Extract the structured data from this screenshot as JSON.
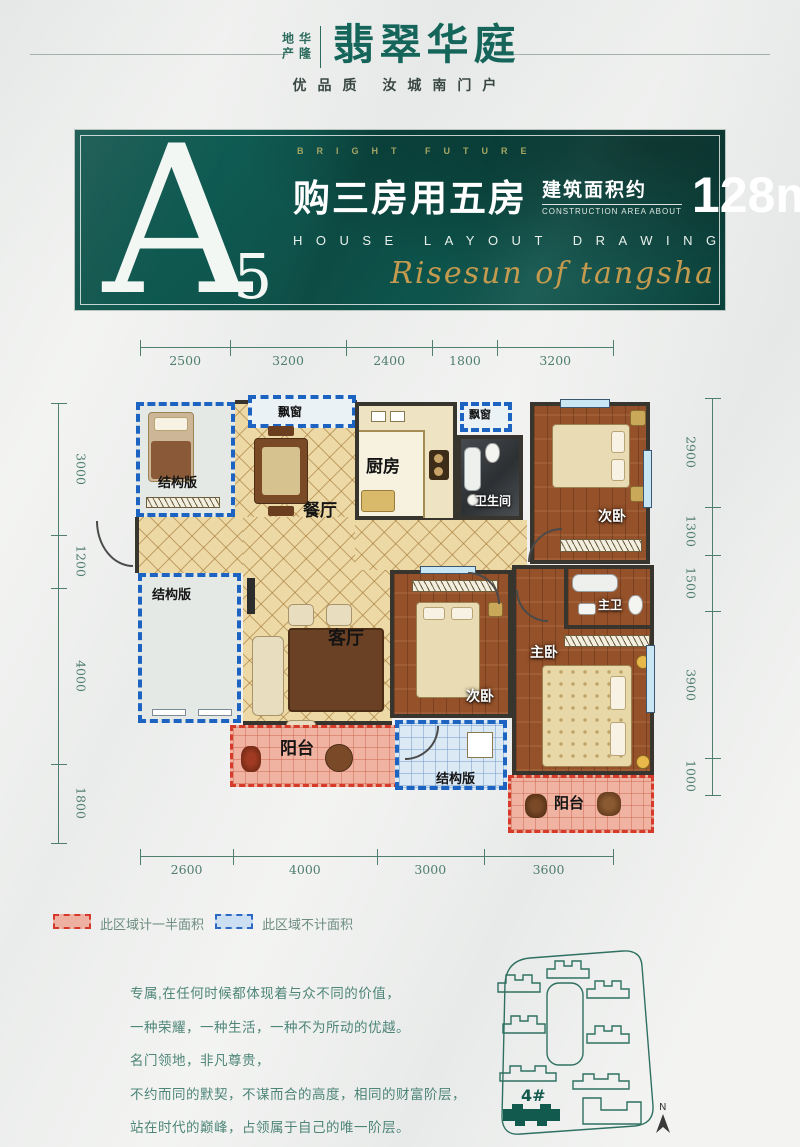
{
  "header": {
    "brand": "华隆地产",
    "title": "翡翠华庭",
    "tagline": "优品质 汝城南门户"
  },
  "banner": {
    "unit": "A",
    "unit_sub": "5",
    "eyebrow": "BRIGHT FUTURE",
    "headline": "购三房用五房",
    "area_label_cn": "建筑面积约",
    "area_label_en": "CONSTRUCTION AREA ABOUT",
    "area_value": "128m",
    "area_sup": "2",
    "subtitle": "HOUSE LAYOUT DRAWING",
    "script_text": "Risesun of tangsha"
  },
  "plan": {
    "dims": {
      "top": [
        2500,
        3200,
        2400,
        1800,
        3200
      ],
      "bottom": [
        2600,
        4000,
        3000,
        3600
      ],
      "left": [
        3000,
        1200,
        4000,
        1800
      ],
      "right": [
        2900,
        1300,
        1500,
        3900,
        1000
      ]
    },
    "rooms": {
      "structure_tl": "结构版",
      "structure_bl": "结构版",
      "structure_b": "结构版",
      "bay1": "飘窗",
      "bay2": "飘窗",
      "kitchen": "厨房",
      "bath": "卫生间",
      "dining": "餐厅",
      "living": "客厅",
      "bedroom1": "次卧",
      "bedroom2": "次卧",
      "master": "主卧",
      "master_bath": "主卫",
      "balcony1": "阳台",
      "balcony2": "阳台"
    }
  },
  "legend": {
    "half_area": "此区域计一半面积",
    "no_area": "此区域不计面积"
  },
  "copy": {
    "lines": [
      "专属,在任何时候都体现着与众不同的价值，",
      "一种荣耀，一种生活，一种不为所动的优越。",
      "名门领地，非凡尊贵，",
      "不约而同的默契，不谋而合的高度，相同的财富阶层，",
      "站在时代的巅峰，占领属于自己的唯一阶层。"
    ]
  },
  "siteplan": {
    "building_label": "4#",
    "north_label": "N"
  },
  "colors": {
    "teal": "#0d5a51",
    "gold": "#c49a4e",
    "dim_line": "#4f7d70",
    "wall": "#38352e",
    "blue_dash": "#1d64c2",
    "red_dash": "#d63a2a",
    "tile_floor": "#ecd9a6",
    "wood_floor": "#94512a",
    "balcony_pink": "#f0b2a1"
  }
}
